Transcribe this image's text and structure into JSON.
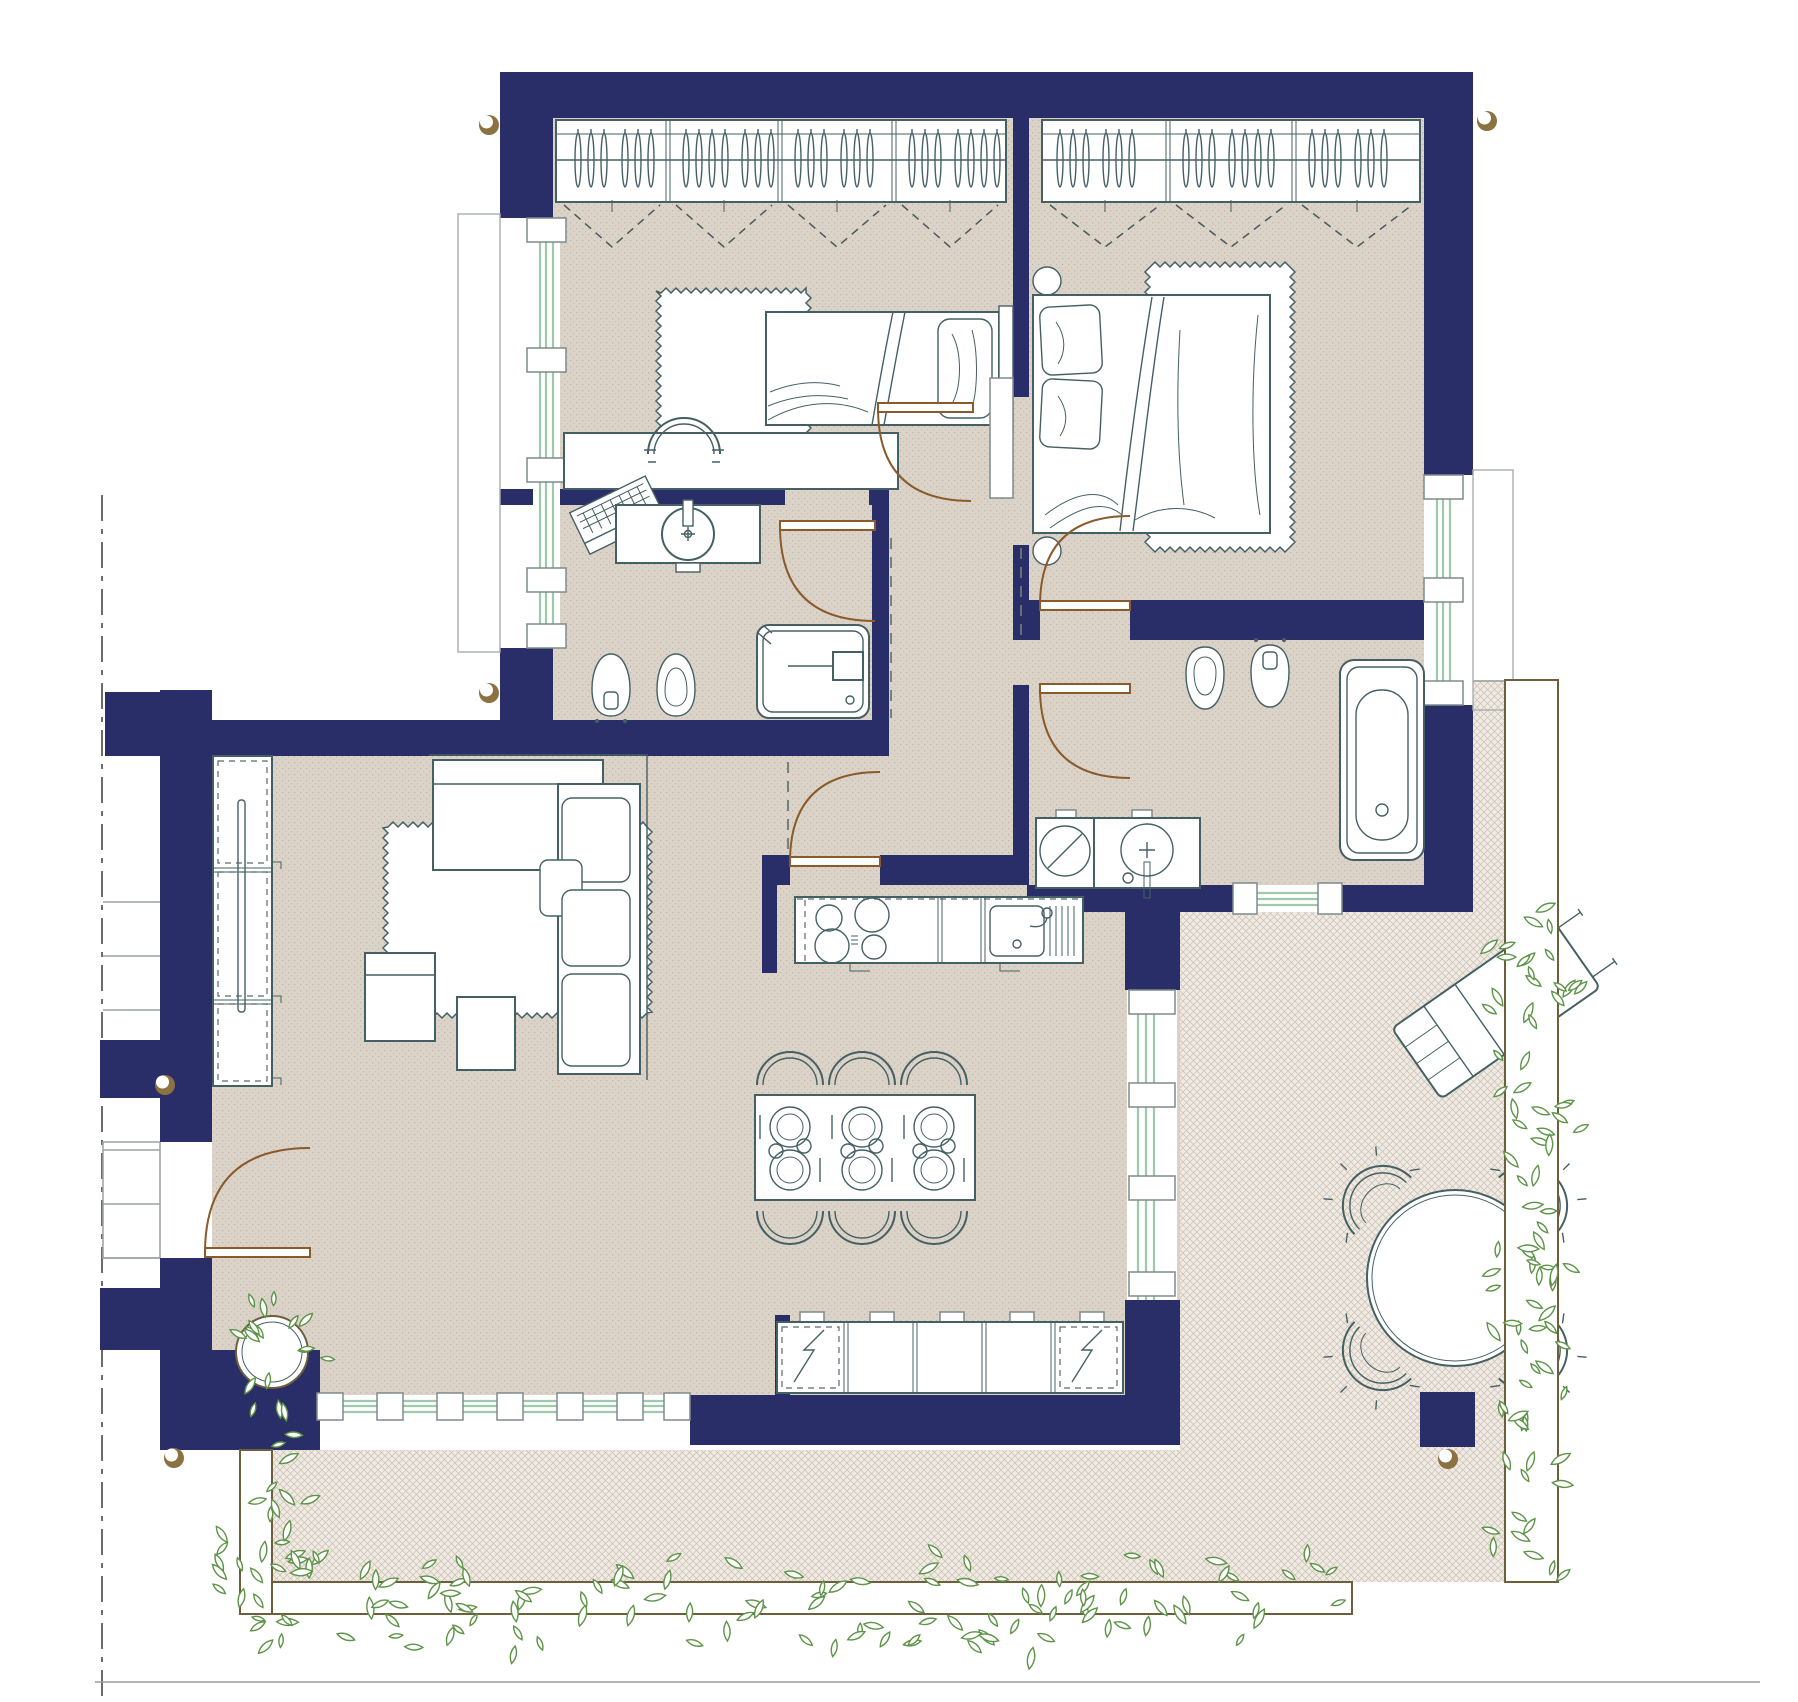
{
  "meta": {
    "kind": "architectural-floor-plan",
    "canvas": {
      "width": 1798,
      "height": 1702
    },
    "visible_text": []
  },
  "palette": {
    "wall": "#2a2e68",
    "floor": "#dbd3c8",
    "terrace": "#efeae3",
    "terraceLine": "#a5947e",
    "stroke": "#456064",
    "door": "#8a5a2b",
    "window": "#9ec9ab",
    "plant": "#5d9447",
    "planter": "#6d5f3c",
    "marker": "#8a7340",
    "gray": "#9aa0a0",
    "floorDot": "#7d6e5c"
  },
  "rooms": [
    {
      "id": "bedroom-1",
      "furniture": [
        "wardrobe-with-hangers",
        "single-bed",
        "rug",
        "desk",
        "desk-chair",
        "laptop"
      ]
    },
    {
      "id": "bedroom-2",
      "furniture": [
        "wardrobe-with-hangers",
        "double-bed",
        "rug",
        "round-stool",
        "round-stool"
      ]
    },
    {
      "id": "bathroom-1",
      "furniture": [
        "vanity-washbasin",
        "toilet",
        "bidet",
        "shower-enclosure"
      ]
    },
    {
      "id": "bathroom-2",
      "furniture": [
        "bidet",
        "toilet",
        "bathtub",
        "washing-machine",
        "washbasin-counter"
      ]
    },
    {
      "id": "hallway",
      "furniture": []
    },
    {
      "id": "living-room",
      "furniture": [
        "tall-cabinet",
        "corner-sofa",
        "cushions",
        "rug",
        "armchair",
        "coffee-table",
        "potted-plant",
        "entry-door"
      ]
    },
    {
      "id": "kitchen-dining",
      "furniture": [
        "cooktop-counter",
        "sink-counter",
        "lower-cabinets-with-appliances",
        "dining-table-6",
        "dining-chairs"
      ]
    },
    {
      "id": "terrace",
      "furniture": [
        "sun-lounger",
        "round-table",
        "garden-chairs",
        "pillar"
      ]
    },
    {
      "id": "balcony-planters",
      "furniture": [
        "planter-left",
        "planter-bottom",
        "planter-right"
      ]
    }
  ],
  "decor": {
    "rugs": [
      {
        "x": 661,
        "y": 293,
        "w": 145,
        "h": 163
      },
      {
        "x": 1150,
        "y": 267,
        "w": 140,
        "h": 280
      },
      {
        "x": 388,
        "y": 827,
        "w": 259,
        "h": 186
      }
    ],
    "hangerRows": [
      {
        "y": 160,
        "ry": 27,
        "xs": [
          578,
          591,
          604,
          625,
          638,
          651,
          686,
          699,
          712,
          725,
          745,
          758,
          771,
          798,
          811,
          824,
          844,
          857,
          870,
          912,
          925,
          938,
          958,
          971,
          984,
          997
        ]
      },
      {
        "y": 160,
        "ry": 27,
        "xs": [
          1060,
          1073,
          1086,
          1106,
          1119,
          1132,
          1186,
          1199,
          1212,
          1232,
          1245,
          1258,
          1271,
          1312,
          1325,
          1338,
          1358,
          1371,
          1384
        ]
      }
    ],
    "wardrobeSections": [
      [
        556,
        668,
        780,
        894,
        1006
      ],
      [
        1042,
        1168,
        1294,
        1420
      ]
    ],
    "vMarks": {
      "yTop": 205,
      "yBottom": 247
    },
    "stairs": {
      "x1": 103,
      "x2": 160,
      "ys": [
        902,
        956,
        1010,
        1150,
        1204,
        1258
      ]
    },
    "markers": [
      [
        489,
        125
      ],
      [
        1487,
        121
      ],
      [
        489,
        693
      ],
      [
        165,
        1085
      ],
      [
        174,
        1458
      ],
      [
        1448,
        1459
      ]
    ],
    "dining": {
      "table": {
        "x": 755,
        "y": 1095,
        "w": 220,
        "h": 105
      },
      "settings": [
        [
          790,
          1127,
          0
        ],
        [
          862,
          1127,
          0
        ],
        [
          934,
          1127,
          0
        ],
        [
          790,
          1170,
          180
        ],
        [
          862,
          1170,
          180
        ],
        [
          934,
          1170,
          180
        ]
      ],
      "chairs": [
        [
          790,
          1079,
          0
        ],
        [
          862,
          1079,
          0
        ],
        [
          934,
          1079,
          0
        ],
        [
          790,
          1217,
          180
        ],
        [
          862,
          1217,
          180
        ],
        [
          934,
          1217,
          180
        ]
      ]
    },
    "terraceSet": {
      "cx": 1455,
      "cy": 1278,
      "r": 88,
      "chairDist": 112,
      "angles": [
        45,
        135,
        225,
        315
      ]
    },
    "leafClusters": [
      {
        "type": "strip",
        "x": 276,
        "y": 1556,
        "w": 1056,
        "h": 92,
        "count": 115,
        "seed": 7
      },
      {
        "type": "strip",
        "x": 1492,
        "y": 900,
        "w": 84,
        "h": 676,
        "count": 85,
        "seed": 11
      },
      {
        "type": "strip",
        "x": 210,
        "y": 1434,
        "w": 104,
        "h": 224,
        "count": 32,
        "seed": 3
      },
      {
        "type": "radial",
        "cx": 272,
        "cy": 1352,
        "rMin": 16,
        "rMax": 58,
        "count": 18,
        "seed": 5
      }
    ]
  }
}
